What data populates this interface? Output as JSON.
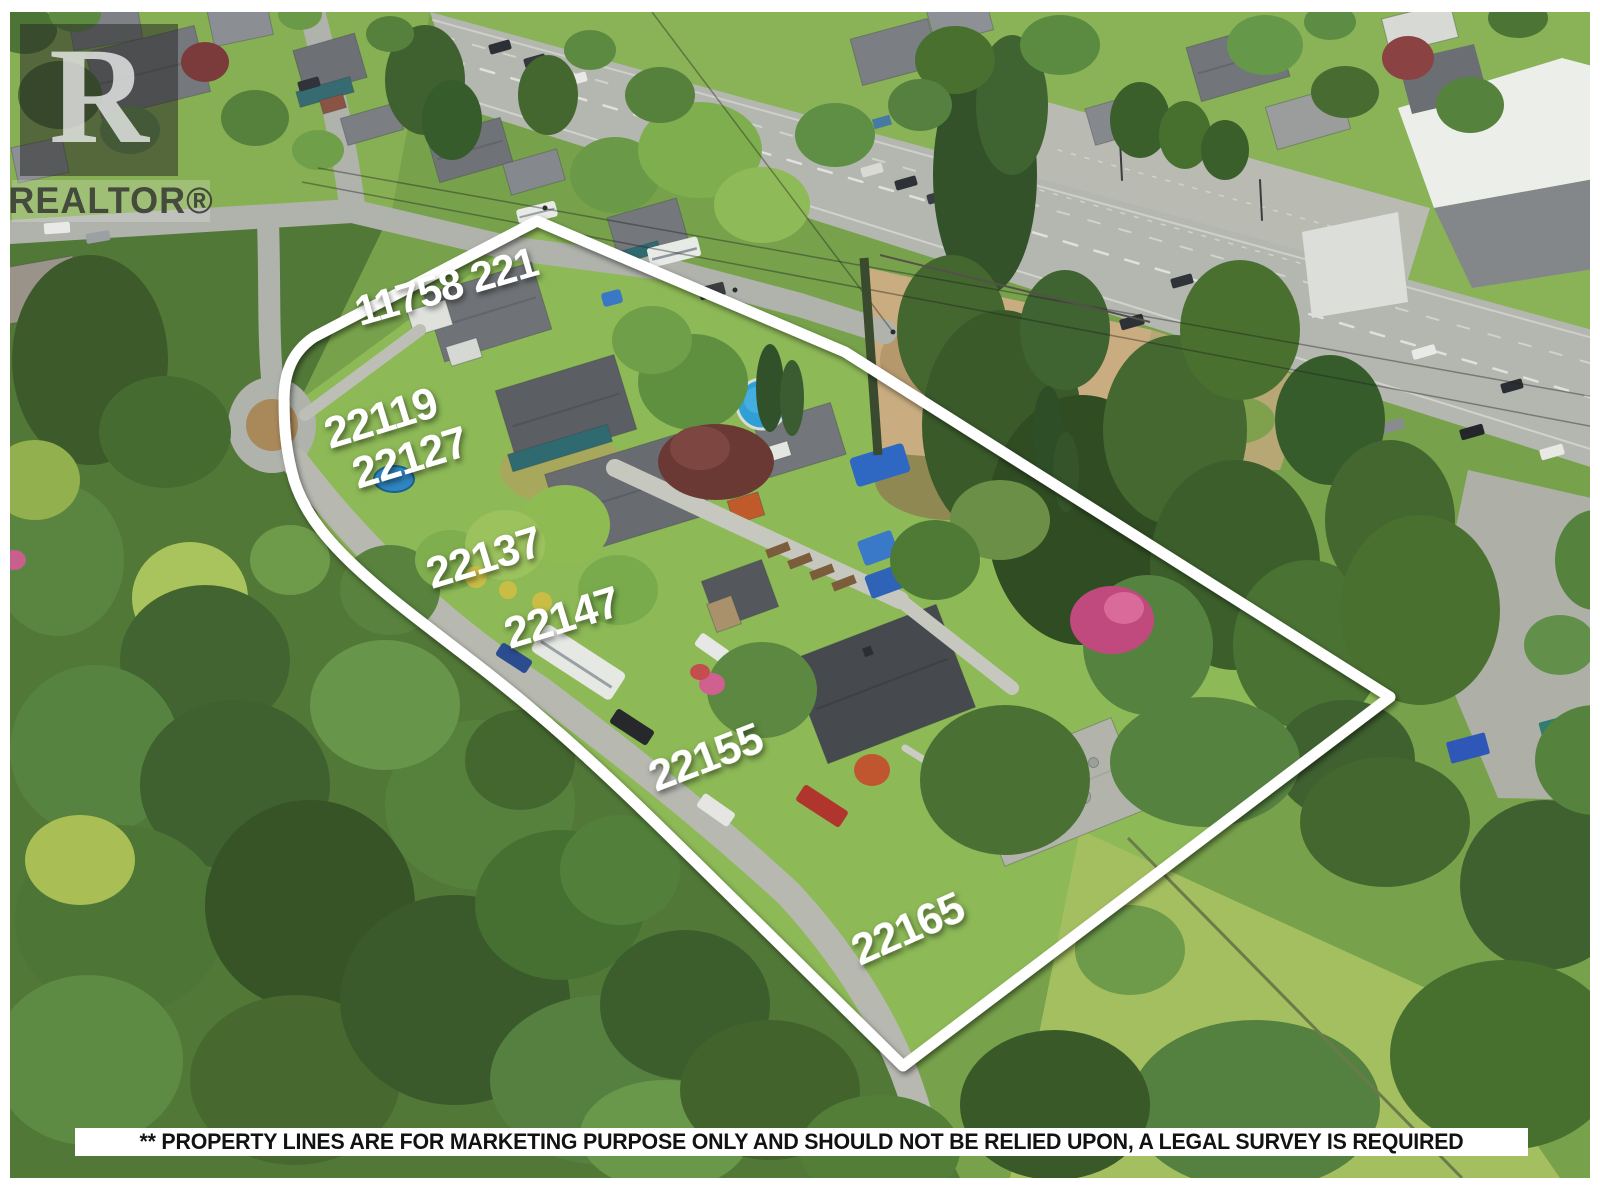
{
  "watermark": {
    "logo_letter": "R",
    "label": "REALTOR®"
  },
  "property_labels": [
    {
      "text": "11758 221"
    },
    {
      "text": "22119"
    },
    {
      "text": "22127"
    },
    {
      "text": "22137"
    },
    {
      "text": "22147"
    },
    {
      "text": "22155"
    },
    {
      "text": "22165"
    }
  ],
  "disclaimer": "** PROPERTY LINES ARE FOR MARKETING PURPOSE ONLY AND SHOULD NOT BE RELIED UPON, A LEGAL SURVEY IS REQUIRED",
  "colors": {
    "boundary_line": "#ffffff",
    "label_text": "#ffffff",
    "disclaimer_bg": "#ffffff",
    "disclaimer_text": "#121212",
    "frame": "#ffffff"
  }
}
